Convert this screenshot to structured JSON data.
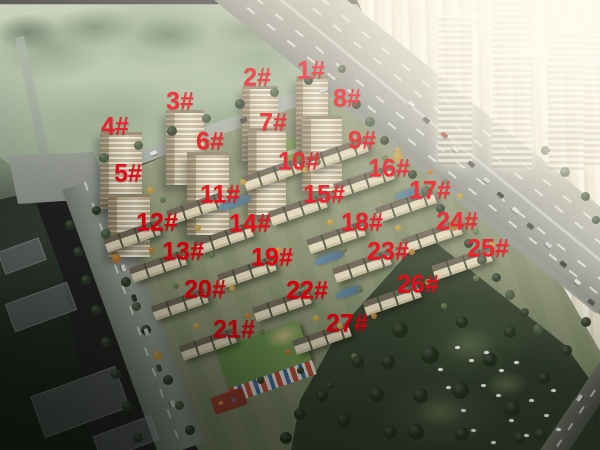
{
  "scene": {
    "kind": "aerial-rendering-of-residential-complex",
    "annotation_style": "red-bold-building-numbers"
  },
  "colors": {
    "label_red": "#e8000e"
  },
  "building_labels": [
    {
      "text": "1#",
      "x": 311,
      "y": 71
    },
    {
      "text": "2#",
      "x": 257,
      "y": 78
    },
    {
      "text": "3#",
      "x": 180,
      "y": 102
    },
    {
      "text": "4#",
      "x": 115,
      "y": 127
    },
    {
      "text": "5#",
      "x": 128,
      "y": 174
    },
    {
      "text": "6#",
      "x": 210,
      "y": 142
    },
    {
      "text": "7#",
      "x": 273,
      "y": 123
    },
    {
      "text": "8#",
      "x": 347,
      "y": 99
    },
    {
      "text": "9#",
      "x": 362,
      "y": 141
    },
    {
      "text": "10#",
      "x": 299,
      "y": 162
    },
    {
      "text": "11#",
      "x": 220,
      "y": 195
    },
    {
      "text": "12#",
      "x": 157,
      "y": 223
    },
    {
      "text": "13#",
      "x": 183,
      "y": 252
    },
    {
      "text": "14#",
      "x": 250,
      "y": 224
    },
    {
      "text": "15#",
      "x": 324,
      "y": 195
    },
    {
      "text": "16#",
      "x": 389,
      "y": 169
    },
    {
      "text": "17#",
      "x": 430,
      "y": 191
    },
    {
      "text": "18#",
      "x": 362,
      "y": 223
    },
    {
      "text": "19#",
      "x": 272,
      "y": 258
    },
    {
      "text": "20#",
      "x": 205,
      "y": 290
    },
    {
      "text": "21#",
      "x": 234,
      "y": 330
    },
    {
      "text": "22#",
      "x": 307,
      "y": 291
    },
    {
      "text": "23#",
      "x": 388,
      "y": 252
    },
    {
      "text": "24#",
      "x": 457,
      "y": 222
    },
    {
      "text": "25#",
      "x": 488,
      "y": 249
    },
    {
      "text": "26#",
      "x": 418,
      "y": 285
    },
    {
      "text": "27#",
      "x": 347,
      "y": 324
    }
  ]
}
